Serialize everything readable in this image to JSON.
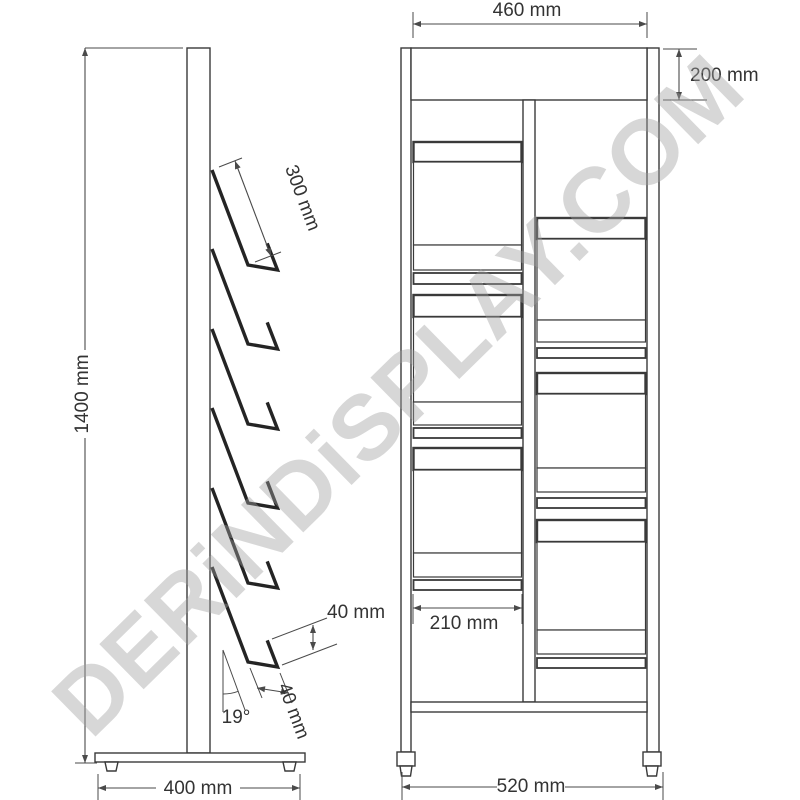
{
  "watermark": {
    "text": "DERiNDiSPLAY.COM"
  },
  "colors": {
    "background": "#ffffff",
    "line": "#3a3a3a",
    "thick_line": "#242424",
    "dim_line": "#4a4a4a",
    "text": "#333333",
    "watermark": "rgba(160,160,160,0.42)"
  },
  "side_view": {
    "pocket_count": 6,
    "dims": {
      "total_height": "1400 mm",
      "pocket_length": "300 mm",
      "lip_height": "40 mm",
      "pocket_depth": "40 mm",
      "tilt_angle": "19°",
      "base_depth": "400 mm"
    }
  },
  "front_view": {
    "pocket_count": 6,
    "dims": {
      "total_width": "460 mm",
      "header_height": "200 mm",
      "pocket_width": "210 mm",
      "base_width": "520 mm"
    }
  }
}
